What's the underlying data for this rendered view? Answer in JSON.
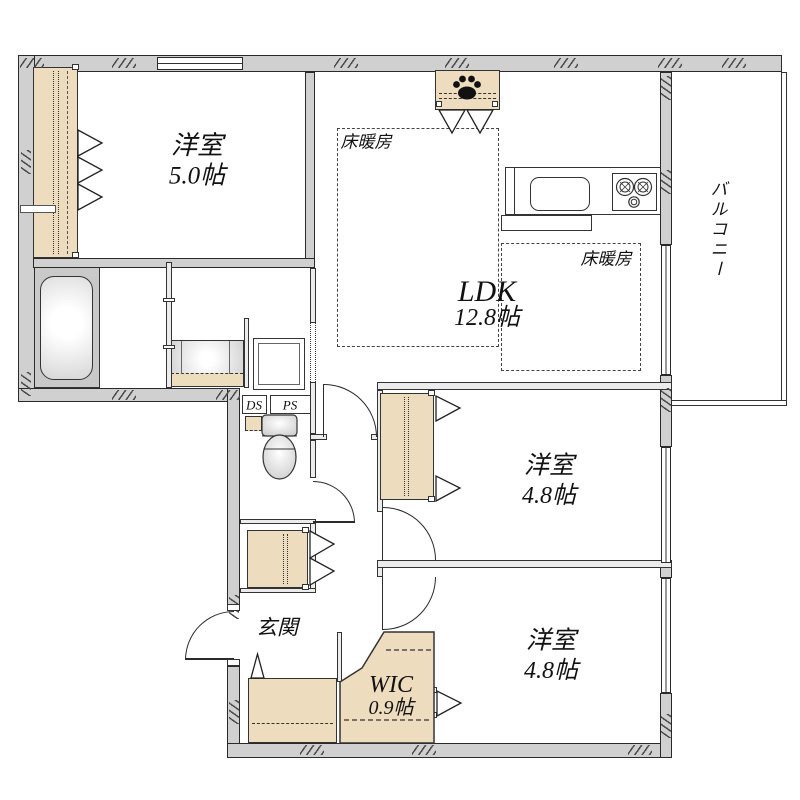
{
  "plan_title": "floor-plan",
  "rooms": {
    "bedroom_top": {
      "name": "洋室",
      "size": "5.0帖"
    },
    "ldk": {
      "name": "LDK",
      "size": "12.8帖"
    },
    "bedroom_mid": {
      "name": "洋室",
      "size": "4.8帖"
    },
    "bedroom_bottom": {
      "name": "洋室",
      "size": "4.8帖"
    },
    "wic": {
      "name": "WIC",
      "size": "0.9帖"
    },
    "entrance": {
      "name": "玄関"
    },
    "balcony": {
      "name": "バルコニー"
    }
  },
  "annotations": {
    "floor_heating": "床暖房",
    "duct_space": "DS",
    "pipe_space": "PS"
  },
  "colors": {
    "wall_fill": "#d0d0d0",
    "storage_fill": "#eedcbf",
    "line": "#2b2b2b",
    "fixture_gray": "#c9c9c9"
  }
}
